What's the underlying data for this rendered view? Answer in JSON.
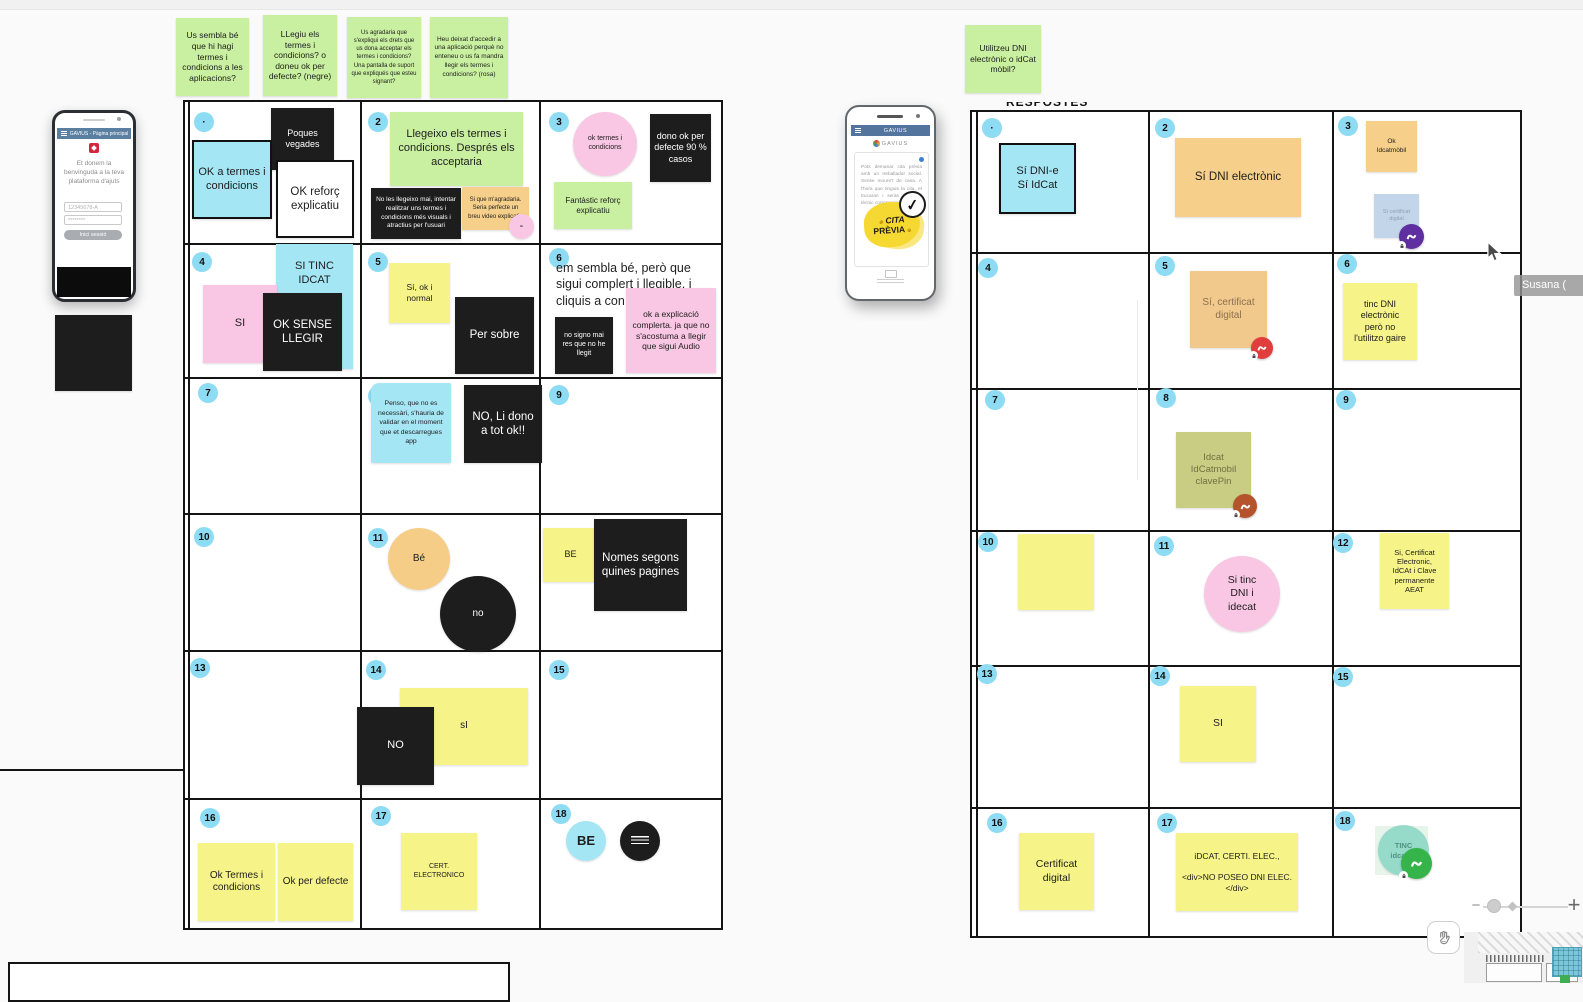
{
  "palette": {
    "green": "#c9f0a0",
    "cyan": "#a4e6f4",
    "black": "#1d1d1d",
    "white": "#ffffff",
    "pink": "#f9c7e3",
    "orange": "#f6cf8a",
    "yellow": "#f6f388",
    "olive": "#c9cd84",
    "badge_blue": "#8edcf3",
    "gray_blue": "#b9d0e6",
    "teal": "#8ed8c6",
    "header_blue": "#5b7fa0",
    "avatar_purple": "#5f2ea0",
    "avatar_red": "#e23d3d",
    "avatar_brown": "#b5532c",
    "avatar_green": "#35b44a"
  },
  "questions": {
    "q1": "Us sembla bé que hi hagi termes i condicions a les aplicacions?",
    "q2": "LLegiu els termes i condicions? o doneu ok per defecte? (negre)",
    "q3": "Us agradaria que s'expliqui els drets que us dona acceptar els termes i condicions? Una pantalla de suport que expliqués que esteu signant?",
    "q4": "Heu deixat d'accedir a una aplicació perquè no enteneu o us fa mandra llegir els termes i condicions? (rosa)",
    "q5": "Utilitzeu DNI electrònic o idCat mòbil?"
  },
  "phone_left": {
    "header": "GAVIUS - Pàgina principal",
    "welcome": "Et donem la benvinguda a la teva plataforma d'ajuts",
    "user_value": "12345678-A",
    "pass_value": "********",
    "login_label": "Inici sessió"
  },
  "phone_right": {
    "header": "GAVIUS",
    "brand": "GAVIUS",
    "body": "Pots demanar cita prèvia amb un treballador social. Sense moure't de casa. A l'hora que tinguis la cita, et trucaran i seràs atès pel tècnic corresponent.",
    "cta_line1": "CITA",
    "cta_line2": "PRÈVIA",
    "check": "✓"
  },
  "left_grid": {
    "badges": [
      "·",
      "2",
      "3",
      "4",
      "5",
      "6",
      "7",
      "8",
      "9",
      "10",
      "11",
      "12",
      "13",
      "14",
      "15",
      "16",
      "17",
      "18"
    ],
    "c1_black": "Poques vegades",
    "c1_cyan": "OK a termes i condicions",
    "c1_white": "OK reforç explicatiu",
    "c2_green": "Llegeixo els termes i condicions. Després els acceptaria",
    "c2_black": "No les llegeixo mai, intentar realitzar uns termes i condicions més visuals i atractius per l'usuari",
    "c2_orange": "Si que m'agradaria. Seria perfecte un breu video explicatiu",
    "c2_dot": "-",
    "c3_pink": "ok termes i condicions",
    "c3_black": "dono ok per defecte 90 % casos",
    "c3_green": "Fantàstic reforç explicatiu",
    "c4_pink": "SI",
    "c4_cyan": "SI TINC IDCAT",
    "c4_black": "OK SENSE LLEGIR",
    "c5_yellow": "Sí, ok i normal",
    "c5_black": "Per sobre",
    "c6_note": "em sembla bé, però que sigui complert i llegible. i cliquis a con",
    "c6_black": "no signo mai res que no he llegit",
    "c6_pink": "ok a explicació complerta. ja que no s'acostuma a llegir que sigui Audio",
    "c8_cyan": "Penso, que no  es necessàri, s'hauria de validar en el moment que et descarregues app",
    "c8_black": "NO, Li dono a tot ok!!",
    "c11_orange": "Bé",
    "c11_black": "no",
    "c12_yellow": "BE",
    "c12_black": "Nomes segons quines pagines",
    "c14_black": "NO",
    "c14_yellow": "sI",
    "c16_yellow_a": "Ok Termes i condicions",
    "c16_yellow_b": "Ok per defecte",
    "c17_yellow": "CERT. ELECTRONICO",
    "c18_circle": "BE"
  },
  "right_grid": {
    "frame_label": "RESPOSTES",
    "badges": [
      "·",
      "2",
      "3",
      "4",
      "5",
      "6",
      "7",
      "8",
      "9",
      "10",
      "11",
      "12",
      "13",
      "14",
      "15",
      "16",
      "17",
      "18"
    ],
    "c1_cyan": "Sí DNI-e\nSí IdCat",
    "c2_orange": "Sí DNI electrònic",
    "c3_orange": "Ok\nIdcatmòbil",
    "c3_gray": "Sí certificat\ndigital",
    "c5_orange": "Sí, certificat\ndigital",
    "c6_yellow": "tinc DNI\nelectrònic\nperò no\nl'utilitzo gaire",
    "c8_olive": "Idcat\nIdCatmobil\nclavePin",
    "c11_pink": "Si tinc\nDNI i\nidecat",
    "c12_yellow": "Si, Certificat\nElectronic,\nIdCAt i Clave\npermanente\nAEAT",
    "c14_yellow": "SI",
    "c16_yellow": "Certificat\ndigital",
    "c17_yellow": "iDCAT, CERTI. ELEC.,\n\n<div>NO POSEO DNI ELEC.</div>",
    "c18_teal": "TINC\nidcat m"
  },
  "collaborator": {
    "name": "Susana ("
  },
  "controls": {
    "zoom_out": "−",
    "zoom_in": "+"
  }
}
